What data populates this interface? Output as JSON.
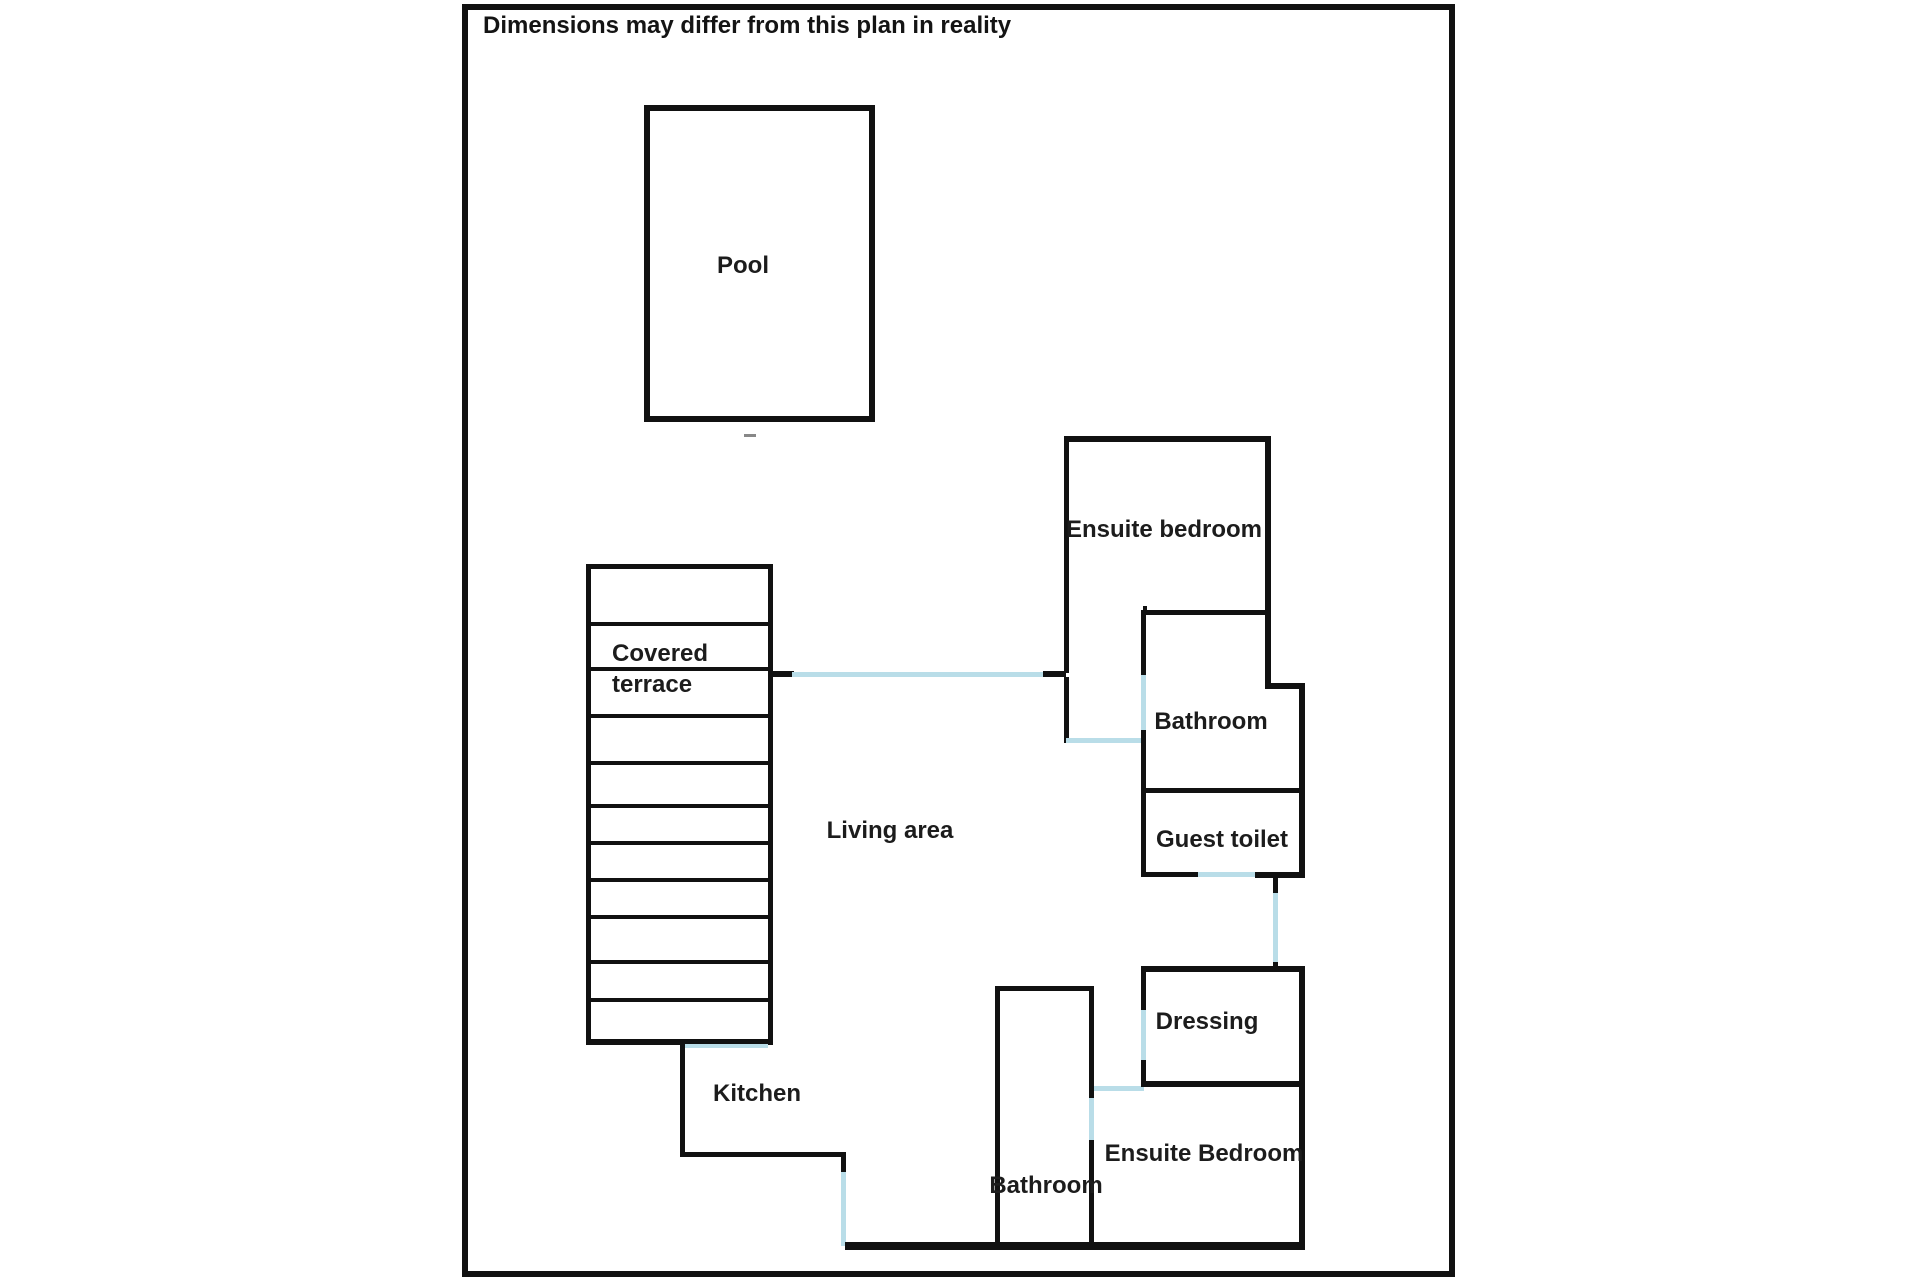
{
  "disclaimer": {
    "text": "Dimensions may differ from this plan in reality"
  },
  "plan": {
    "colors": {
      "wall": "#111111",
      "opening": "#b9dde8",
      "mark": "#888888",
      "text": "#1c1c1c",
      "background": "#ffffff"
    },
    "labels": [
      {
        "id": "label-pool",
        "text": "Pool",
        "x": 743,
        "y": 266,
        "align": "center"
      },
      {
        "id": "label-covered-terrace",
        "text": "Covered\nterrace",
        "x": 612,
        "y": 638,
        "align": "left"
      },
      {
        "id": "label-living-area",
        "text": "Living area",
        "x": 890,
        "y": 831,
        "align": "center"
      },
      {
        "id": "label-ensuite-bedroom-top",
        "text": "Ensuite bedroom",
        "x": 1164,
        "y": 530,
        "align": "center"
      },
      {
        "id": "label-bathroom-right",
        "text": "Bathroom",
        "x": 1211,
        "y": 722,
        "align": "center"
      },
      {
        "id": "label-guest-toilet",
        "text": "Guest toilet",
        "x": 1222,
        "y": 840,
        "align": "center"
      },
      {
        "id": "label-dressing",
        "text": "Dressing",
        "x": 1207,
        "y": 1022,
        "align": "center"
      },
      {
        "id": "label-ensuite-bedroom-bottom",
        "text": "Ensuite Bedroom",
        "x": 1204,
        "y": 1154,
        "align": "center"
      },
      {
        "id": "label-bathroom-bottom",
        "text": "Bathroom",
        "x": 1046,
        "y": 1186,
        "align": "center"
      },
      {
        "id": "label-kitchen",
        "text": "Kitchen",
        "x": 757,
        "y": 1094,
        "align": "center"
      }
    ],
    "walls": [
      {
        "id": "outer-border-top",
        "x": 462,
        "y": 4,
        "w": 993,
        "h": 6
      },
      {
        "id": "outer-border-bottom",
        "x": 462,
        "y": 1271,
        "w": 993,
        "h": 6
      },
      {
        "id": "outer-border-left",
        "x": 462,
        "y": 4,
        "w": 6,
        "h": 1273
      },
      {
        "id": "outer-border-right",
        "x": 1449,
        "y": 4,
        "w": 6,
        "h": 1273
      },
      {
        "id": "pool-wall-top",
        "x": 644,
        "y": 105,
        "w": 231,
        "h": 6
      },
      {
        "id": "pool-wall-bottom",
        "x": 644,
        "y": 416,
        "w": 231,
        "h": 6
      },
      {
        "id": "pool-wall-left",
        "x": 644,
        "y": 105,
        "w": 6,
        "h": 317
      },
      {
        "id": "pool-wall-right",
        "x": 869,
        "y": 105,
        "w": 6,
        "h": 317
      },
      {
        "id": "pool-tick-mark",
        "x": 744,
        "y": 434,
        "w": 12,
        "h": 3,
        "type": "mark"
      },
      {
        "id": "terrace-wall-left",
        "x": 586,
        "y": 564,
        "w": 5,
        "h": 481
      },
      {
        "id": "terrace-wall-right",
        "x": 768,
        "y": 564,
        "w": 5,
        "h": 481
      },
      {
        "id": "terrace-wall-top",
        "x": 586,
        "y": 564,
        "w": 187,
        "h": 5
      },
      {
        "id": "terrace-slat-1",
        "x": 586,
        "y": 622,
        "w": 187,
        "h": 4
      },
      {
        "id": "terrace-slat-2",
        "x": 586,
        "y": 667,
        "w": 187,
        "h": 4
      },
      {
        "id": "terrace-slat-3",
        "x": 586,
        "y": 714,
        "w": 187,
        "h": 4
      },
      {
        "id": "terrace-slat-4",
        "x": 586,
        "y": 761,
        "w": 187,
        "h": 4
      },
      {
        "id": "terrace-slat-5",
        "x": 586,
        "y": 804,
        "w": 187,
        "h": 4
      },
      {
        "id": "terrace-slat-6",
        "x": 586,
        "y": 841,
        "w": 187,
        "h": 4
      },
      {
        "id": "terrace-slat-7",
        "x": 586,
        "y": 878,
        "w": 187,
        "h": 4
      },
      {
        "id": "terrace-slat-8",
        "x": 586,
        "y": 915,
        "w": 187,
        "h": 4
      },
      {
        "id": "terrace-slat-9",
        "x": 586,
        "y": 960,
        "w": 187,
        "h": 4
      },
      {
        "id": "terrace-slat-10",
        "x": 586,
        "y": 998,
        "w": 187,
        "h": 4
      },
      {
        "id": "terrace-wall-bottom",
        "x": 586,
        "y": 1039,
        "w": 187,
        "h": 6
      },
      {
        "id": "terrace-bottom-door-opening",
        "x": 683,
        "y": 1044,
        "w": 85,
        "h": 4,
        "type": "opening"
      },
      {
        "id": "terrace-door-stub",
        "x": 768,
        "y": 671,
        "w": 26,
        "h": 6
      },
      {
        "id": "living-glass-wall-opening",
        "x": 792,
        "y": 672,
        "w": 251,
        "h": 5,
        "type": "opening"
      },
      {
        "id": "living-glass-wall-stub",
        "x": 1043,
        "y": 671,
        "w": 23,
        "h": 6
      },
      {
        "id": "kitchen-wall-left",
        "x": 680,
        "y": 1043,
        "w": 5,
        "h": 114
      },
      {
        "id": "kitchen-wall-bottom",
        "x": 680,
        "y": 1152,
        "w": 166,
        "h": 5
      },
      {
        "id": "kitchen-door-stub",
        "x": 841,
        "y": 1152,
        "w": 5,
        "h": 20
      },
      {
        "id": "kitchen-door-opening",
        "x": 841,
        "y": 1172,
        "w": 5,
        "h": 74,
        "type": "opening"
      },
      {
        "id": "house-wall-bottom",
        "x": 845,
        "y": 1242,
        "w": 460,
        "h": 8
      },
      {
        "id": "bathroom2-wall-left",
        "x": 995,
        "y": 986,
        "w": 5,
        "h": 261
      },
      {
        "id": "bathroom2-wall-top",
        "x": 995,
        "y": 986,
        "w": 98,
        "h": 5
      },
      {
        "id": "bathroom2-wall-right-a",
        "x": 1089,
        "y": 986,
        "w": 5,
        "h": 112
      },
      {
        "id": "bathroom2-door-opening",
        "x": 1089,
        "y": 1098,
        "w": 5,
        "h": 42,
        "type": "opening"
      },
      {
        "id": "bathroom2-wall-right-b",
        "x": 1089,
        "y": 1140,
        "w": 5,
        "h": 107
      },
      {
        "id": "hall-window-opening",
        "x": 1094,
        "y": 1086,
        "w": 50,
        "h": 5,
        "type": "opening"
      },
      {
        "id": "ensuite1-wall-top",
        "x": 1064,
        "y": 436,
        "w": 207,
        "h": 6
      },
      {
        "id": "ensuite1-wall-left-a",
        "x": 1064,
        "y": 436,
        "w": 5,
        "h": 237
      },
      {
        "id": "ensuite1-wall-left-b",
        "x": 1064,
        "y": 677,
        "w": 5,
        "h": 66
      },
      {
        "id": "ensuite1-window-opening",
        "x": 1066,
        "y": 738,
        "w": 77,
        "h": 5,
        "type": "opening"
      },
      {
        "id": "ensuite1-wall-right",
        "x": 1265,
        "y": 436,
        "w": 6,
        "h": 253
      },
      {
        "id": "bathroom1-step-wall",
        "x": 1265,
        "y": 683,
        "w": 40,
        "h": 6
      },
      {
        "id": "bathroom1-wall-right",
        "x": 1299,
        "y": 683,
        "w": 6,
        "h": 194
      },
      {
        "id": "bathroom1-wall-tick",
        "x": 1143,
        "y": 606,
        "w": 4,
        "h": 7
      },
      {
        "id": "bathroom1-wall-left-a",
        "x": 1141,
        "y": 610,
        "w": 5,
        "h": 65
      },
      {
        "id": "bathroom1-door-opening",
        "x": 1141,
        "y": 675,
        "w": 5,
        "h": 55,
        "type": "opening"
      },
      {
        "id": "bathroom1-wall-left-b",
        "x": 1141,
        "y": 730,
        "w": 5,
        "h": 145
      },
      {
        "id": "bathroom1-wall-top",
        "x": 1141,
        "y": 610,
        "w": 127,
        "h": 5
      },
      {
        "id": "guest-toilet-wall-top",
        "x": 1141,
        "y": 788,
        "w": 164,
        "h": 5
      },
      {
        "id": "guest-toilet-wall-bottom-a",
        "x": 1141,
        "y": 872,
        "w": 57,
        "h": 5
      },
      {
        "id": "guest-toilet-door-opening",
        "x": 1198,
        "y": 872,
        "w": 57,
        "h": 5,
        "type": "opening"
      },
      {
        "id": "guest-toilet-wall-bottom-b",
        "x": 1255,
        "y": 872,
        "w": 50,
        "h": 6
      },
      {
        "id": "corridor-stub-top",
        "x": 1273,
        "y": 877,
        "w": 5,
        "h": 16
      },
      {
        "id": "corridor-door-opening",
        "x": 1273,
        "y": 893,
        "w": 5,
        "h": 69,
        "type": "opening"
      },
      {
        "id": "corridor-stub-bottom",
        "x": 1273,
        "y": 962,
        "w": 5,
        "h": 9
      },
      {
        "id": "dressing-wall-top",
        "x": 1141,
        "y": 966,
        "w": 164,
        "h": 6
      },
      {
        "id": "dressing-wall-left-a",
        "x": 1141,
        "y": 966,
        "w": 5,
        "h": 44
      },
      {
        "id": "dressing-door-opening",
        "x": 1141,
        "y": 1010,
        "w": 5,
        "h": 50,
        "type": "opening"
      },
      {
        "id": "dressing-wall-left-b",
        "x": 1141,
        "y": 1060,
        "w": 5,
        "h": 27
      },
      {
        "id": "dressing-wall-bottom",
        "x": 1141,
        "y": 1081,
        "w": 164,
        "h": 6
      },
      {
        "id": "dressing-wall-right",
        "x": 1299,
        "y": 966,
        "w": 6,
        "h": 121
      },
      {
        "id": "ensuite2-wall-right",
        "x": 1299,
        "y": 1081,
        "w": 6,
        "h": 169
      }
    ]
  }
}
